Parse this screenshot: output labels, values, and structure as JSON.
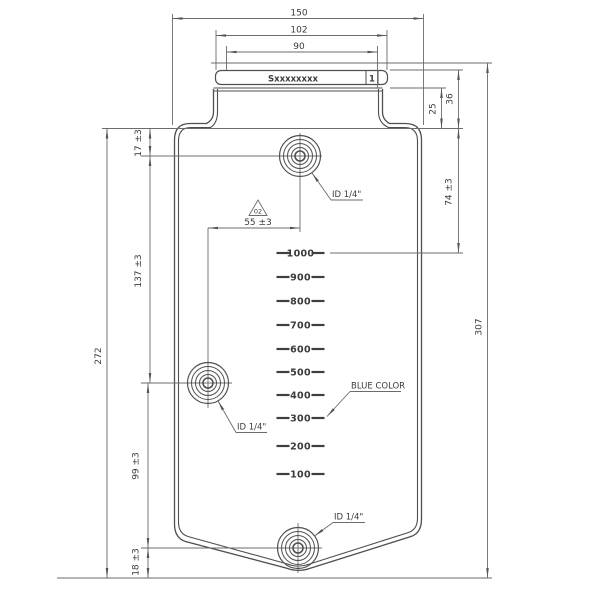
{
  "drawing": {
    "label_plate": {
      "serial": "Sxxxxxxxx",
      "cell": "1"
    },
    "dimensions": {
      "width_overall": "150",
      "width_plate": "102",
      "width_plate_inner": "90",
      "neck_height": "36",
      "plate_to_shoulder": "25",
      "shoulder_to_max_level": "74 ±3",
      "height_overall": "307",
      "shoulder_to_top_port": "17 ±3",
      "top_port_to_side_port": "137 ±3",
      "body_height": "272",
      "side_port_to_bottom_port": "99 ±3",
      "bottom_port_to_base": "18 ±3",
      "port_offset": "55 ±3"
    },
    "revision_marker": "02",
    "port_labels": {
      "top": "ID 1/4\"",
      "side": "ID 1/4\"",
      "bottom": "ID 1/4\""
    },
    "color_note": "BLUE COLOR",
    "graduations": {
      "values": [
        "1000",
        "900",
        "800",
        "700",
        "600",
        "500",
        "400",
        "300",
        "200",
        "100"
      ]
    },
    "line_color": "#4f4f4f",
    "dim_color": "#6b6b6b",
    "text_color": "#3a3a3a"
  }
}
